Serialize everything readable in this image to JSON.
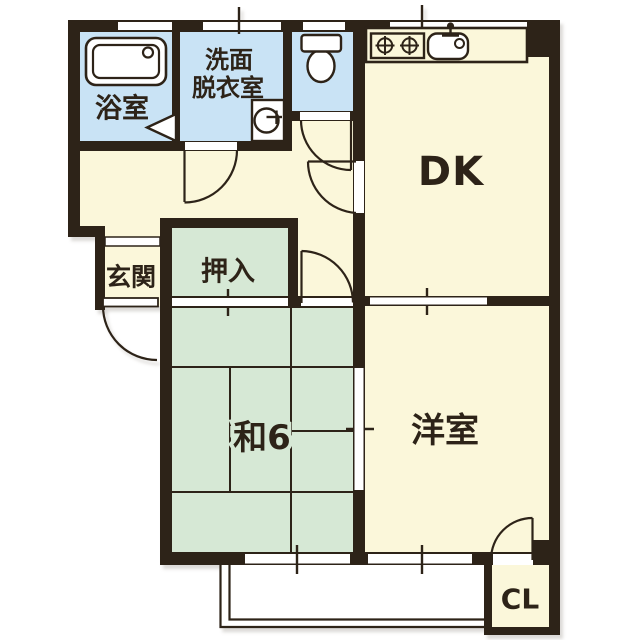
{
  "floor_plan": {
    "type": "apartment-floor-plan",
    "rooms": [
      {
        "id": "bathroom",
        "label": "浴室"
      },
      {
        "id": "washroom",
        "label": "洗面脱衣室",
        "label_line1": "洗面",
        "label_line2": "脱衣室"
      },
      {
        "id": "toilet",
        "label": ""
      },
      {
        "id": "dining_kitchen",
        "label": "DK"
      },
      {
        "id": "entrance",
        "label": "玄関"
      },
      {
        "id": "oshiire_closet",
        "label": "押入"
      },
      {
        "id": "japanese_room_6mat",
        "label": "和6"
      },
      {
        "id": "western_room",
        "label": "洋室"
      },
      {
        "id": "closet",
        "label": "CL"
      }
    ],
    "fixtures": [
      "bathtub-icon",
      "washing-machine-icon",
      "toilet-icon",
      "stove-icon",
      "kitchen-sink-icon",
      "bathroom-folding-door-icon"
    ],
    "features": [
      "balcony",
      "sliding-doors",
      "windows",
      "entrance-door"
    ],
    "colors": {
      "wall": "#2d2318",
      "wet_area_floor": "#c9e3f5",
      "tatami_floor": "#d6e8d5",
      "main_floor": "#fbf7da",
      "background": "#ffffff"
    }
  }
}
